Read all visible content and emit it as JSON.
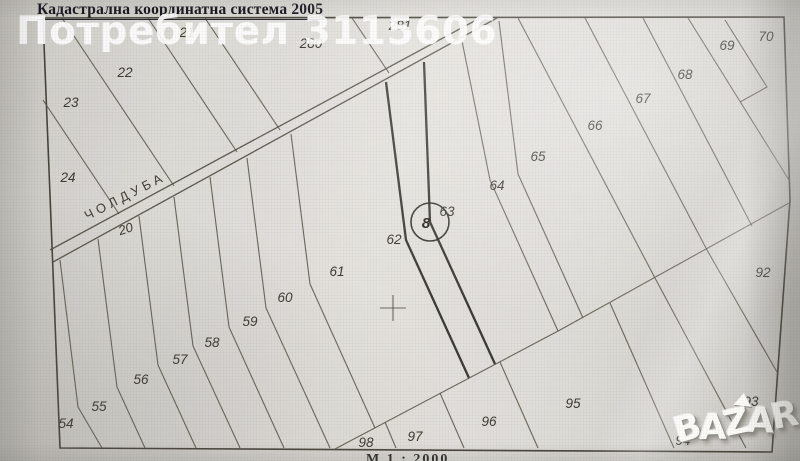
{
  "title": "Кадастрална координатна система 2005",
  "scale_note": "М 1 : 2000",
  "watermarks": {
    "user": "Потребител 3115606",
    "logo": "BAZAR",
    "logo_letters": [
      "B",
      "A",
      "Z",
      "A",
      "R"
    ]
  },
  "road": {
    "name": "ЧОЛДУБА",
    "number": "20"
  },
  "survey_point": {
    "label": "8"
  },
  "colors": {
    "paper": "#dcdad5",
    "line": "#585448",
    "line_bold": "#2d2b25",
    "title_ink": "#15151e",
    "watermark": "#ffffff"
  },
  "parcels": [
    {
      "id": "21",
      "x": 187,
      "y": 33
    },
    {
      "id": "22",
      "x": 125,
      "y": 73
    },
    {
      "id": "23",
      "x": 71,
      "y": 103
    },
    {
      "id": "24",
      "x": 68,
      "y": 178
    },
    {
      "id": "280",
      "x": 311,
      "y": 44
    },
    {
      "id": "281",
      "x": 400,
      "y": 26
    },
    {
      "id": "54",
      "x": 66,
      "y": 424
    },
    {
      "id": "55",
      "x": 99,
      "y": 407
    },
    {
      "id": "56",
      "x": 141,
      "y": 380
    },
    {
      "id": "57",
      "x": 180,
      "y": 360
    },
    {
      "id": "58",
      "x": 212,
      "y": 343
    },
    {
      "id": "59",
      "x": 250,
      "y": 322
    },
    {
      "id": "60",
      "x": 285,
      "y": 298
    },
    {
      "id": "61",
      "x": 337,
      "y": 272
    },
    {
      "id": "62",
      "x": 394,
      "y": 240
    },
    {
      "id": "63",
      "x": 447,
      "y": 212
    },
    {
      "id": "64",
      "x": 497,
      "y": 186
    },
    {
      "id": "65",
      "x": 538,
      "y": 157
    },
    {
      "id": "66",
      "x": 595,
      "y": 126
    },
    {
      "id": "67",
      "x": 643,
      "y": 99
    },
    {
      "id": "68",
      "x": 685,
      "y": 75
    },
    {
      "id": "69",
      "x": 727,
      "y": 46
    },
    {
      "id": "70",
      "x": 766,
      "y": 37
    },
    {
      "id": "92",
      "x": 763,
      "y": 273
    },
    {
      "id": "93",
      "x": 751,
      "y": 402
    },
    {
      "id": "94",
      "x": 683,
      "y": 441
    },
    {
      "id": "95",
      "x": 573,
      "y": 404
    },
    {
      "id": "96",
      "x": 489,
      "y": 422
    },
    {
      "id": "97",
      "x": 415,
      "y": 437
    },
    {
      "id": "98",
      "x": 366,
      "y": 443
    }
  ]
}
